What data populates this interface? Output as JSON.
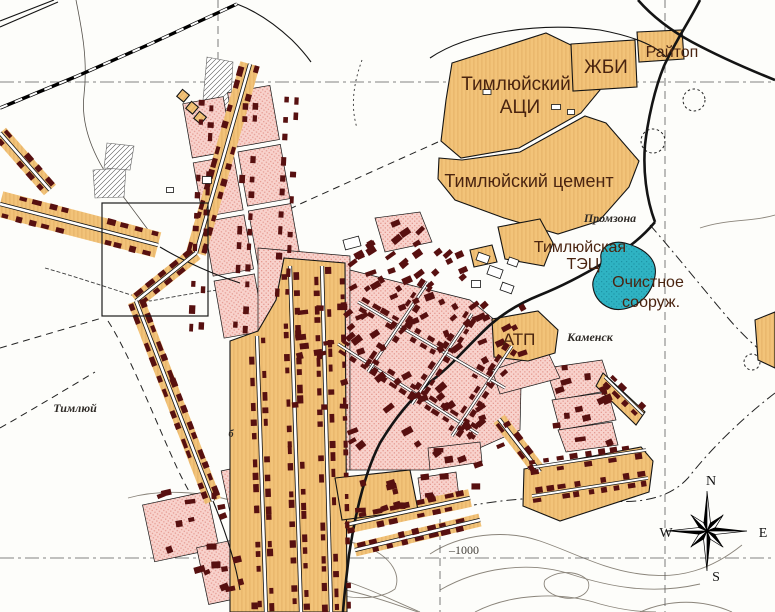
{
  "map": {
    "title": "Town plan of Kamensk / Timlyuy industrial area",
    "labels": {
      "aci": {
        "line1": "Тимлюйский",
        "line2": "АЦИ"
      },
      "zhbi": "ЖБИ",
      "raytop": "Райтоп",
      "cement": "Тимлюйский цемент",
      "tec": {
        "line1": "Тимлюйская",
        "line2": "ТЭЦ"
      },
      "promzona": "Промзона",
      "ochistnoe": {
        "line1": "Очистное",
        "line2": "сооруж."
      },
      "atp": "АТП",
      "kamensk": "Каменск",
      "timlyuy": "Тимлюй",
      "elevation": "–1000",
      "house_letter": "б"
    },
    "compass": {
      "n": "N",
      "w": "W",
      "e": "E",
      "s": "S"
    },
    "colors": {
      "background": "#FDFDFA",
      "residential_tan": "#F2C379",
      "tan_hatch": "#D99F52",
      "residential_pink": "#F8D2CC",
      "pink_dot": "#E59A91",
      "building_dark_red": "#571010",
      "water_teal": "#2FB3C3",
      "teal_dot": "#1D93A5",
      "label_industrial": "#4A2410",
      "label_place": "#2E2A26",
      "line_black": "#141414",
      "contour_gray": "#8a847a",
      "grid_gray": "#5c5c5c"
    }
  }
}
